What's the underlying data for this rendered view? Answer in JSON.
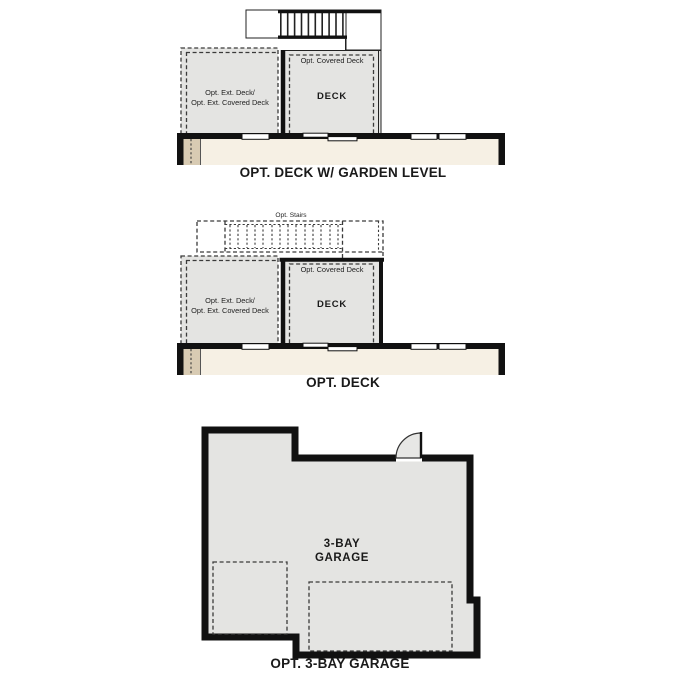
{
  "colors": {
    "wall": "#111111",
    "deck-fill": "#e4e4e2",
    "house-fill": "#f6f0e4",
    "tan-fill": "#d8cbb3",
    "ink": "#1a1a1a"
  },
  "plans": {
    "deck_garden": {
      "title": "OPT. DECK W/ GARDEN LEVEL",
      "covered_deck_label": "Opt. Covered Deck",
      "deck_label": "DECK",
      "ext_deck_line1": "Opt. Ext. Deck/",
      "ext_deck_line2": "Opt. Ext. Covered Deck"
    },
    "deck": {
      "title": "OPT. DECK",
      "stairs_label": "Opt. Stairs",
      "covered_deck_label": "Opt. Covered Deck",
      "deck_label": "DECK",
      "ext_deck_line1": "Opt. Ext. Deck/",
      "ext_deck_line2": "Opt. Ext. Covered Deck"
    },
    "garage": {
      "title": "OPT. 3-BAY GARAGE",
      "room_line1": "3-BAY",
      "room_line2": "GARAGE"
    }
  }
}
